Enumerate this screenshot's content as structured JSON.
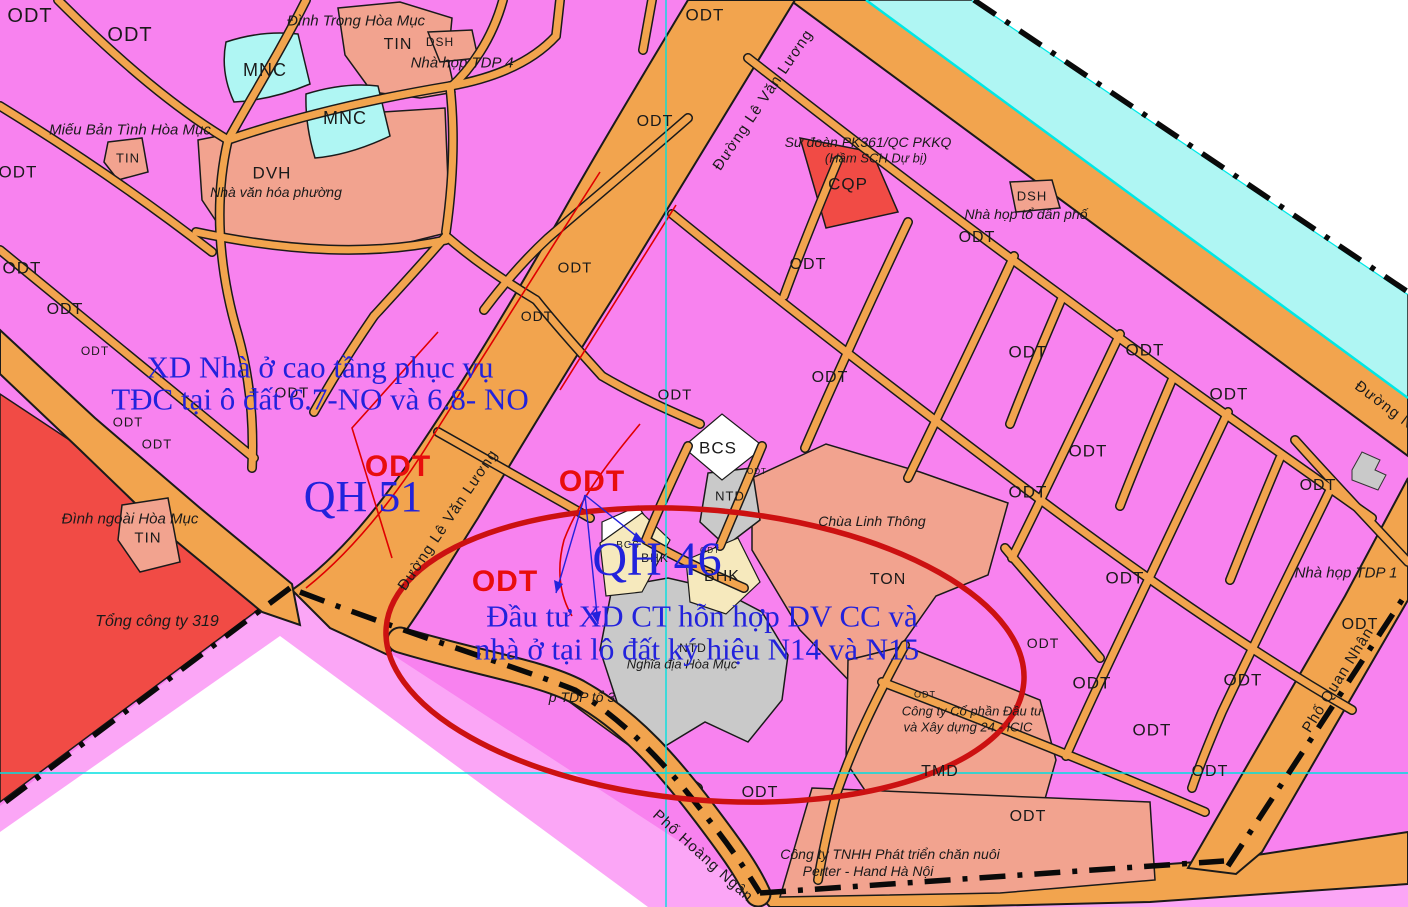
{
  "figure_type": "urban-zoning-plan-map",
  "palette": {
    "map_pink": "#F882EF",
    "outside_pink": "#FBA6F6",
    "road_orange": "#F2A44E",
    "river_cyan": "#AFF6F3",
    "river_line": "#00E8E6",
    "salmon": "#F2A38F",
    "red_zone": "#F14B45",
    "gray_zone": "#C9C9C9",
    "cream_zone": "#F6E9BD",
    "label_ink": "#1A1A1A",
    "ann_blue": "#2222DC",
    "ann_red": "#E80D0D",
    "red_outline": "#E00000",
    "ellipse_red": "#CC1111",
    "grid_cyan": "#00E0E0",
    "boundary": "#0A0A0A"
  },
  "labels": [
    {
      "t": "ODT",
      "x": 30,
      "y": 16,
      "s": 20,
      "c": "k"
    },
    {
      "t": "ODT",
      "x": 130,
      "y": 35,
      "s": 20,
      "c": "k"
    },
    {
      "t": "ODT",
      "x": 18,
      "y": 172,
      "s": 17,
      "c": "k"
    },
    {
      "t": "ODT",
      "x": 705,
      "y": 15,
      "s": 17,
      "c": "k"
    },
    {
      "t": "ODT",
      "x": 655,
      "y": 122,
      "s": 16,
      "c": "k"
    },
    {
      "t": "ODT",
      "x": 22,
      "y": 268,
      "s": 17,
      "c": "k"
    },
    {
      "t": "ODT",
      "x": 65,
      "y": 310,
      "s": 16,
      "c": "k"
    },
    {
      "t": "ODT",
      "x": 575,
      "y": 268,
      "s": 15,
      "c": "k"
    },
    {
      "t": "ODT",
      "x": 537,
      "y": 316,
      "s": 14,
      "c": "k"
    },
    {
      "t": "ODT",
      "x": 292,
      "y": 393,
      "s": 15,
      "c": "k"
    },
    {
      "t": "ODT",
      "x": 95,
      "y": 351,
      "s": 12,
      "c": "k"
    },
    {
      "t": "ODT",
      "x": 128,
      "y": 422,
      "s": 13,
      "c": "k"
    },
    {
      "t": "ODT",
      "x": 157,
      "y": 444,
      "s": 13,
      "c": "k"
    },
    {
      "t": "ODT",
      "x": 808,
      "y": 265,
      "s": 16,
      "c": "k"
    },
    {
      "t": "ODT",
      "x": 977,
      "y": 238,
      "s": 16,
      "c": "k"
    },
    {
      "t": "ODT",
      "x": 830,
      "y": 378,
      "s": 16,
      "c": "k"
    },
    {
      "t": "ODT",
      "x": 675,
      "y": 395,
      "s": 15,
      "c": "k"
    },
    {
      "t": "ODT",
      "x": 1028,
      "y": 352,
      "s": 17,
      "c": "k"
    },
    {
      "t": "ODT",
      "x": 1145,
      "y": 350,
      "s": 17,
      "c": "k"
    },
    {
      "t": "ODT",
      "x": 1229,
      "y": 394,
      "s": 17,
      "c": "k"
    },
    {
      "t": "ODT",
      "x": 1088,
      "y": 451,
      "s": 17,
      "c": "k"
    },
    {
      "t": "ODT",
      "x": 1028,
      "y": 492,
      "s": 17,
      "c": "k"
    },
    {
      "t": "ODT",
      "x": 1318,
      "y": 486,
      "s": 16,
      "c": "k"
    },
    {
      "t": "ODT",
      "x": 1125,
      "y": 578,
      "s": 17,
      "c": "k"
    },
    {
      "t": "ODT",
      "x": 1360,
      "y": 625,
      "s": 16,
      "c": "k"
    },
    {
      "t": "ODT",
      "x": 1243,
      "y": 680,
      "s": 17,
      "c": "k"
    },
    {
      "t": "ODT",
      "x": 1152,
      "y": 730,
      "s": 17,
      "c": "k"
    },
    {
      "t": "ODT",
      "x": 1210,
      "y": 772,
      "s": 16,
      "c": "k"
    },
    {
      "t": "ODT",
      "x": 1092,
      "y": 683,
      "s": 17,
      "c": "k"
    },
    {
      "t": "ODT",
      "x": 1028,
      "y": 817,
      "s": 16,
      "c": "k"
    },
    {
      "t": "ODT",
      "x": 760,
      "y": 793,
      "s": 16,
      "c": "k"
    },
    {
      "t": "ODT",
      "x": 1043,
      "y": 643,
      "s": 14,
      "c": "k"
    },
    {
      "t": "ODT",
      "x": 925,
      "y": 695,
      "s": 9,
      "c": "k"
    },
    {
      "t": "ODT",
      "x": 710,
      "y": 551,
      "s": 8,
      "c": "k"
    },
    {
      "t": "ODT",
      "x": 757,
      "y": 472,
      "s": 8,
      "c": "k"
    },
    {
      "t": "MNC",
      "x": 265,
      "y": 70,
      "s": 18,
      "c": "k"
    },
    {
      "t": "MNC",
      "x": 345,
      "y": 118,
      "s": 18,
      "c": "k"
    },
    {
      "t": "TIN",
      "x": 398,
      "y": 45,
      "s": 16,
      "c": "k"
    },
    {
      "t": "DSH",
      "x": 440,
      "y": 42,
      "s": 12,
      "c": "k"
    },
    {
      "t": "TIN",
      "x": 128,
      "y": 158,
      "s": 13,
      "c": "k"
    },
    {
      "t": "DVH",
      "x": 272,
      "y": 173,
      "s": 17,
      "c": "k"
    },
    {
      "t": "CQP",
      "x": 848,
      "y": 184,
      "s": 17,
      "c": "k"
    },
    {
      "t": "DSH",
      "x": 1032,
      "y": 196,
      "s": 13,
      "c": "k"
    },
    {
      "t": "BCS",
      "x": 718,
      "y": 448,
      "s": 17,
      "c": "k"
    },
    {
      "t": "NTD",
      "x": 730,
      "y": 496,
      "s": 13,
      "c": "k"
    },
    {
      "t": "TON",
      "x": 888,
      "y": 580,
      "s": 16,
      "c": "k"
    },
    {
      "t": "BHK",
      "x": 722,
      "y": 577,
      "s": 16,
      "c": "k"
    },
    {
      "t": "BHK",
      "x": 655,
      "y": 558,
      "s": 12,
      "c": "k"
    },
    {
      "t": "BCS",
      "x": 628,
      "y": 546,
      "s": 10,
      "c": "k"
    },
    {
      "t": "NTD",
      "x": 693,
      "y": 648,
      "s": 12,
      "c": "k"
    },
    {
      "t": "TIN",
      "x": 148,
      "y": 538,
      "s": 15,
      "c": "k"
    },
    {
      "t": "TMD",
      "x": 940,
      "y": 772,
      "s": 16,
      "c": "k"
    },
    {
      "t": "Đình Trong Hòa Mục",
      "x": 356,
      "y": 21,
      "s": 15,
      "c": "i"
    },
    {
      "t": "Nhà họp TDP 4",
      "x": 462,
      "y": 63,
      "s": 15,
      "c": "i"
    },
    {
      "t": "Miếu Bản Tình Hòa Mục",
      "x": 130,
      "y": 130,
      "s": 15,
      "c": "i"
    },
    {
      "t": "Nhà văn hóa phường",
      "x": 276,
      "y": 192,
      "s": 14,
      "c": "i"
    },
    {
      "t": "Sư đoàn PK361/QC PKKQ",
      "x": 868,
      "y": 142,
      "s": 14,
      "c": "i"
    },
    {
      "t": "(Hầm SCH Dự bị)",
      "x": 876,
      "y": 158,
      "s": 13,
      "c": "i"
    },
    {
      "t": "Nhà họp tổ dân phố",
      "x": 1026,
      "y": 214,
      "s": 14,
      "c": "i"
    },
    {
      "t": "Chùa Linh Thông",
      "x": 872,
      "y": 521,
      "s": 14,
      "c": "i"
    },
    {
      "t": "Đình ngoài Hòa Mục",
      "x": 130,
      "y": 519,
      "s": 15,
      "c": "i"
    },
    {
      "t": "Tổng công ty 319",
      "x": 157,
      "y": 622,
      "s": 16,
      "c": "i"
    },
    {
      "t": "Nghĩa địa Hòa Mục",
      "x": 682,
      "y": 664,
      "s": 13,
      "c": "i"
    },
    {
      "t": "p TDP tổ 3",
      "x": 582,
      "y": 697,
      "s": 14,
      "c": "i"
    },
    {
      "t": "Công ty Cổ phần Đầu tư",
      "x": 972,
      "y": 711,
      "s": 13,
      "c": "i"
    },
    {
      "t": "và Xây dựng 24 - ICIC",
      "x": 968,
      "y": 727,
      "s": 13,
      "c": "i"
    },
    {
      "t": "Công ty TNHH Phát triển chăn nuôi",
      "x": 890,
      "y": 854,
      "s": 14,
      "c": "i"
    },
    {
      "t": "Perter - Hand Hà Nội",
      "x": 868,
      "y": 871,
      "s": 14,
      "c": "i"
    },
    {
      "t": "Nhà họp TDP 1",
      "x": 1346,
      "y": 573,
      "s": 15,
      "c": "i"
    },
    {
      "t": "Đường Lê Văn Lương",
      "x": 763,
      "y": 100,
      "s": 15,
      "c": "road",
      "r": -56
    },
    {
      "t": "Đường Lê Văn Lương",
      "x": 448,
      "y": 520,
      "s": 15,
      "c": "road",
      "r": -56
    },
    {
      "t": "Phố Hoàng Ngân",
      "x": 703,
      "y": 856,
      "s": 15,
      "c": "road",
      "r": 42
    },
    {
      "t": "Phố Quan Nhân",
      "x": 1338,
      "y": 680,
      "s": 15,
      "c": "road",
      "r": -58
    },
    {
      "t": "Đường Ng",
      "x": 1388,
      "y": 408,
      "s": 15,
      "c": "road",
      "r": 37
    },
    {
      "t": "XD Nhà ở cao tầng phục vụ",
      "x": 320,
      "y": 367,
      "s": 31,
      "c": "ab"
    },
    {
      "t": "TĐC tại ô đất 6.7-NO và 6.8- NO",
      "x": 320,
      "y": 399,
      "s": 31,
      "c": "ab"
    },
    {
      "t": "Đầu tư XD CT hỗn hợp DV CC và",
      "x": 702,
      "y": 616,
      "s": 31,
      "c": "ab"
    },
    {
      "t": "nhà ở tại lô đất ký hiệu N14 và N15",
      "x": 697,
      "y": 649,
      "s": 31,
      "c": "ab"
    },
    {
      "t": "QH 51",
      "x": 363,
      "y": 497,
      "s": 44,
      "c": "qh"
    },
    {
      "t": "QH 46",
      "x": 657,
      "y": 560,
      "s": 48,
      "c": "qh"
    },
    {
      "t": "ODT",
      "x": 398,
      "y": 467,
      "s": 30,
      "c": "ar"
    },
    {
      "t": "ODT",
      "x": 592,
      "y": 482,
      "s": 30,
      "c": "ar"
    },
    {
      "t": "ODT",
      "x": 505,
      "y": 582,
      "s": 30,
      "c": "ar"
    }
  ]
}
